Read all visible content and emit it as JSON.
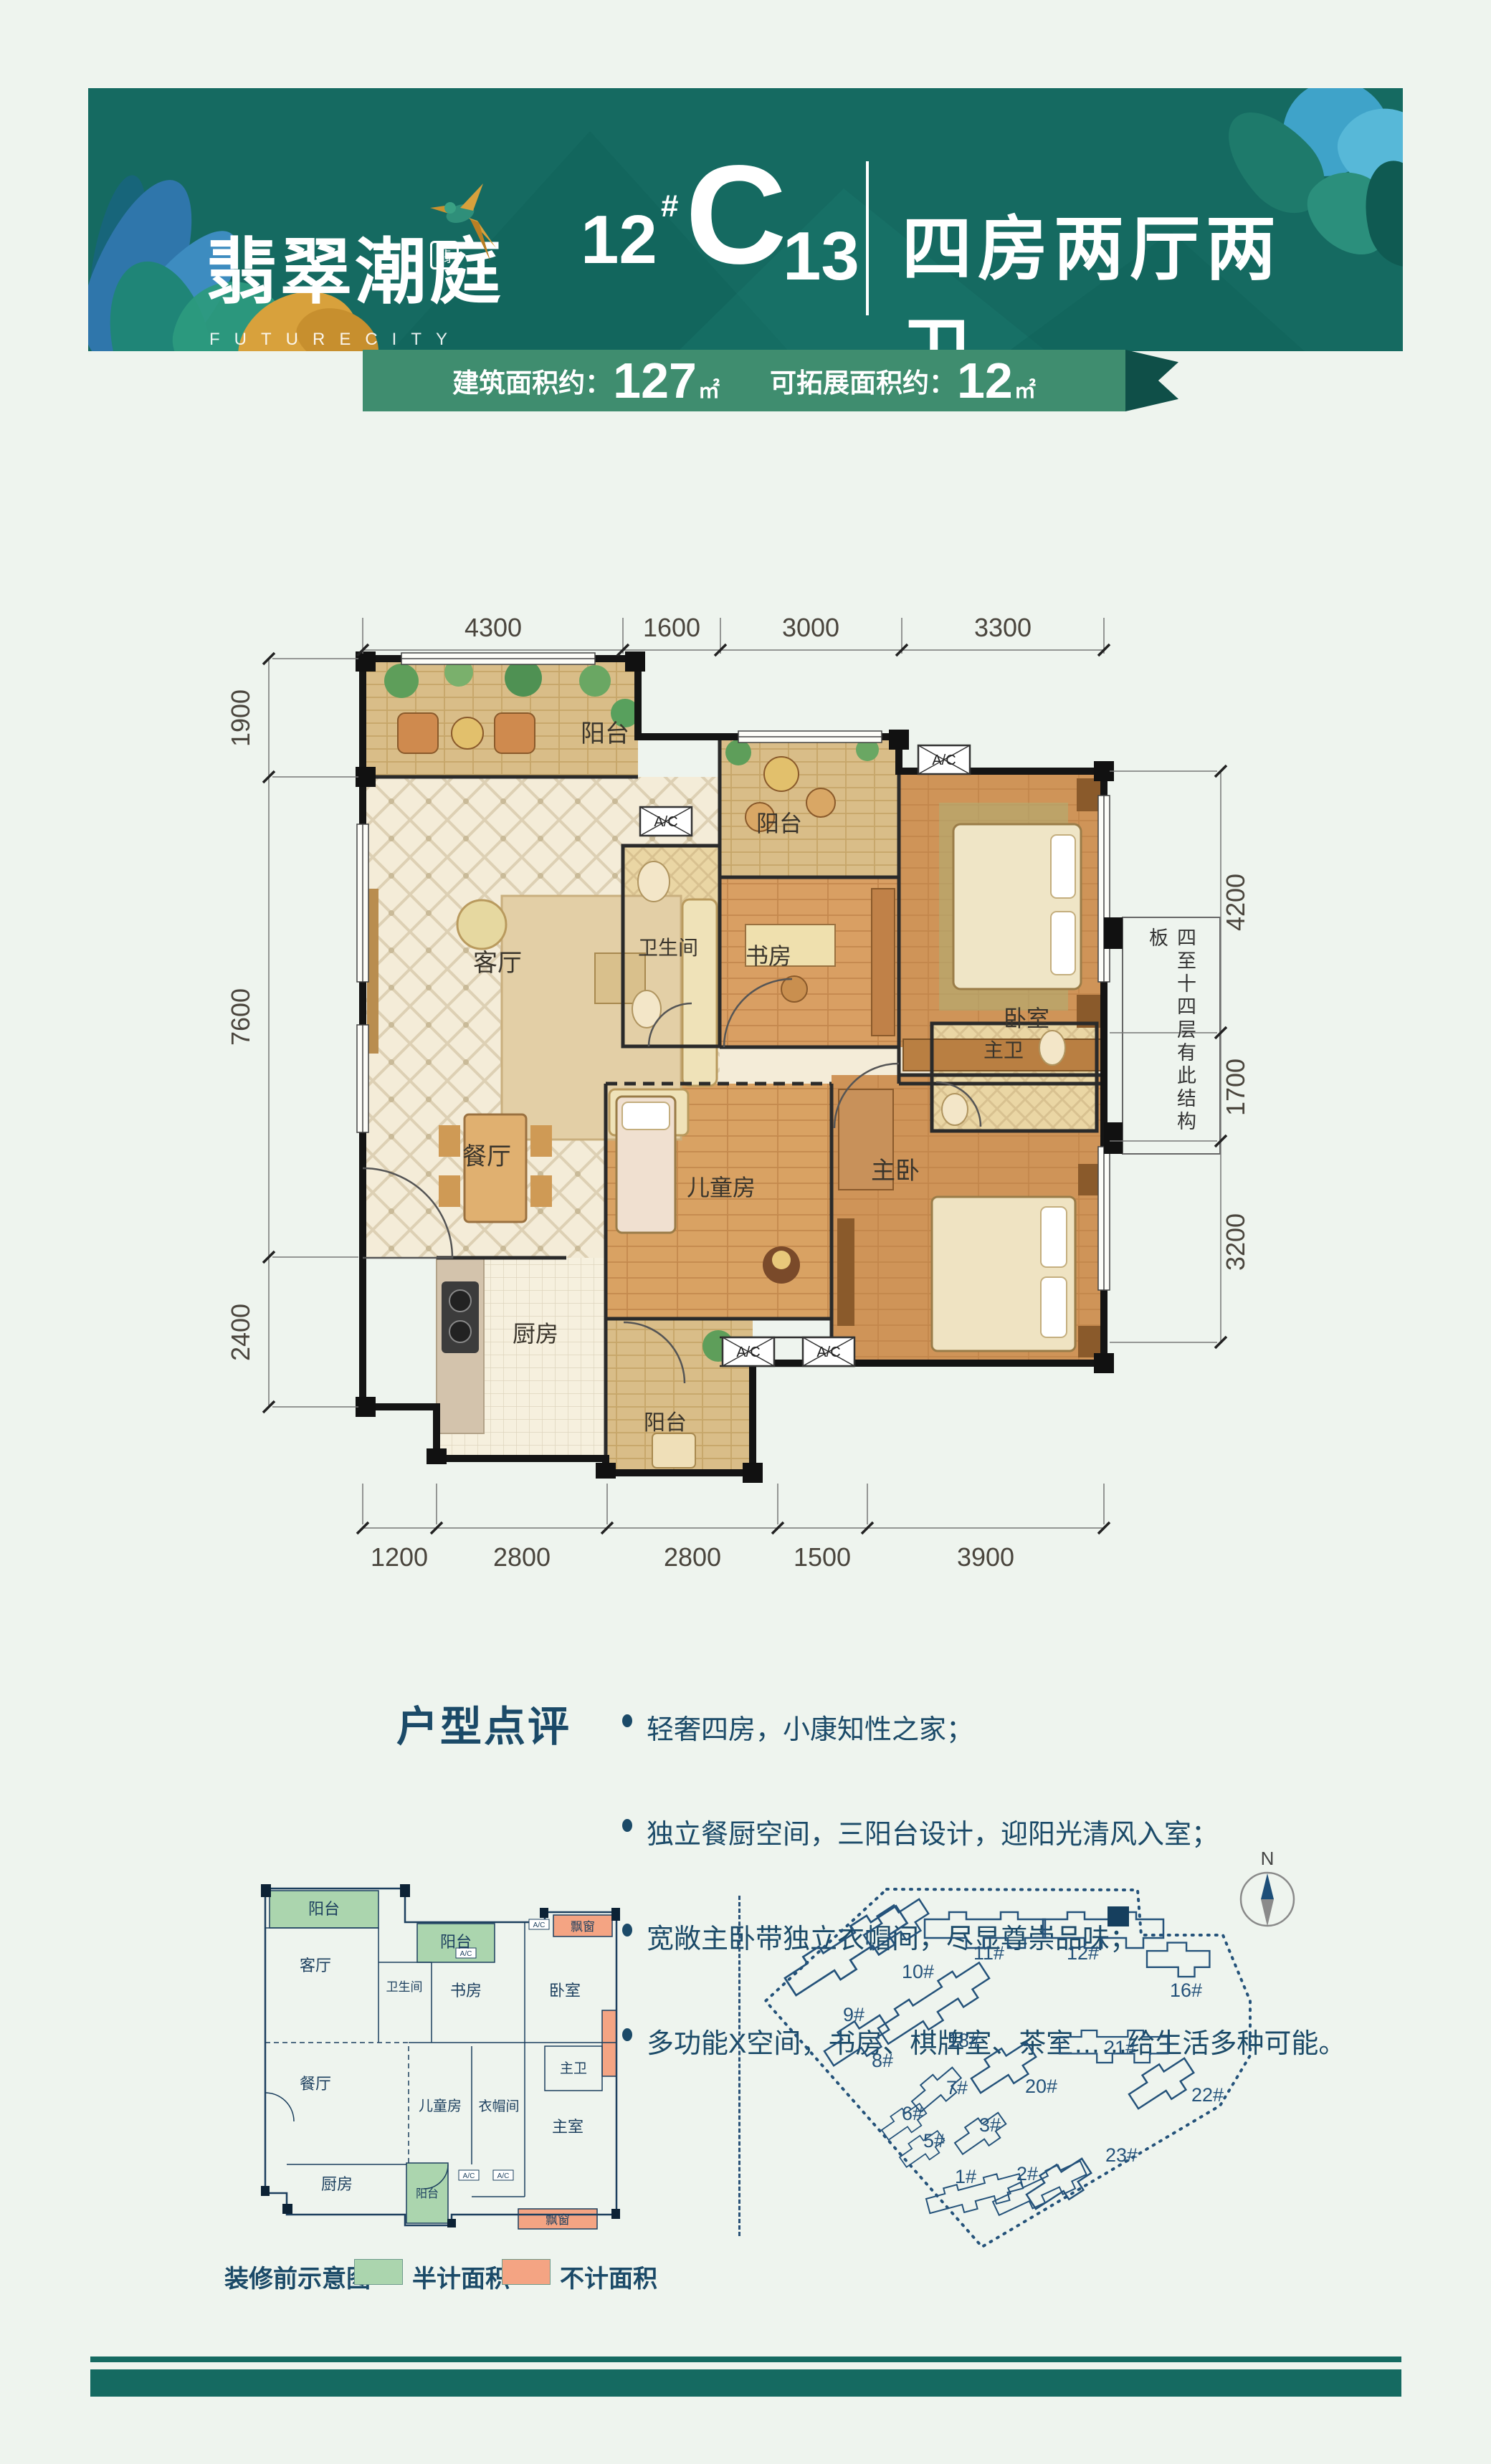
{
  "header": {
    "logo_cn": "翡翠潮庭",
    "logo_seal": "翡",
    "logo_en": "FUTURECITY",
    "block_num": "12",
    "hash": "#",
    "unit_letter": "C",
    "unit_num": "13",
    "type_title": "四房两厅两卫",
    "ribbon": {
      "label1": "建筑面积约：",
      "value1": "127",
      "unit1": "㎡",
      "label2": "可拓展面积约：",
      "value2": "12",
      "unit2": "㎡"
    }
  },
  "plan": {
    "rooms": {
      "balcony1": "阳台",
      "living": "客厅",
      "bath": "卫生间",
      "balcony2": "阳台",
      "study": "书房",
      "bedroom": "卧室",
      "dining": "餐厅",
      "kids": "儿童房",
      "master": "主卧",
      "master_bath": "主卫",
      "kitchen": "厨房",
      "balcony3": "阳台"
    },
    "ac_label": "A/C",
    "note_right": "四至十四层有此结构板",
    "dims": {
      "top": [
        "4300",
        "1600",
        "3000",
        "3300"
      ],
      "left": [
        "1900",
        "7600",
        "2400"
      ],
      "right": [
        "4200",
        "1700",
        "3200"
      ],
      "bottom": [
        "1200",
        "2800",
        "2800",
        "1500",
        "3900"
      ]
    }
  },
  "review": {
    "title": "户型点评",
    "bullets": [
      "轻奢四房，小康知性之家；",
      "独立餐厨空间，三阳台设计，迎阳光清风入室；",
      "宽敞主卧带独立衣帽间，尽显尊崇品味；",
      "多功能X空间，书房、棋牌室、茶室……给生活多种可能。"
    ]
  },
  "mini_plan": {
    "rooms": {
      "balcony_tl": "阳台",
      "living": "客厅",
      "bath": "卫生间",
      "balcony_tm": "阳台",
      "study": "书房",
      "bedroom": "卧室",
      "bay_tr": "飘窗",
      "dining": "餐厅",
      "kids": "儿童房",
      "cloak": "衣帽间",
      "master_bath": "主卫",
      "master": "主室",
      "kitchen": "厨房",
      "balcony_b": "阳台",
      "bay_br": "飘窗"
    },
    "ac_label": "A/C",
    "legend": {
      "note": "装修前示意图",
      "half": "半计面积",
      "none": "不计面积"
    }
  },
  "site_map": {
    "north": "N",
    "labels": [
      "9#",
      "10#",
      "11#",
      "12#",
      "16#",
      "18#",
      "8#",
      "7#",
      "20#",
      "21#",
      "6#",
      "5#",
      "3#",
      "22#",
      "1#",
      "2#",
      "23#"
    ]
  },
  "colors": {
    "banner_teal": "#156a61",
    "ribbon_green": "#3f8d6f",
    "ribbon_fold": "#0f4f48",
    "text_navy": "#1b4a68",
    "legend_green": "#abd5ae",
    "legend_orange": "#f4a483",
    "map_line": "#24527a",
    "page_bg": "#eef4ee"
  }
}
